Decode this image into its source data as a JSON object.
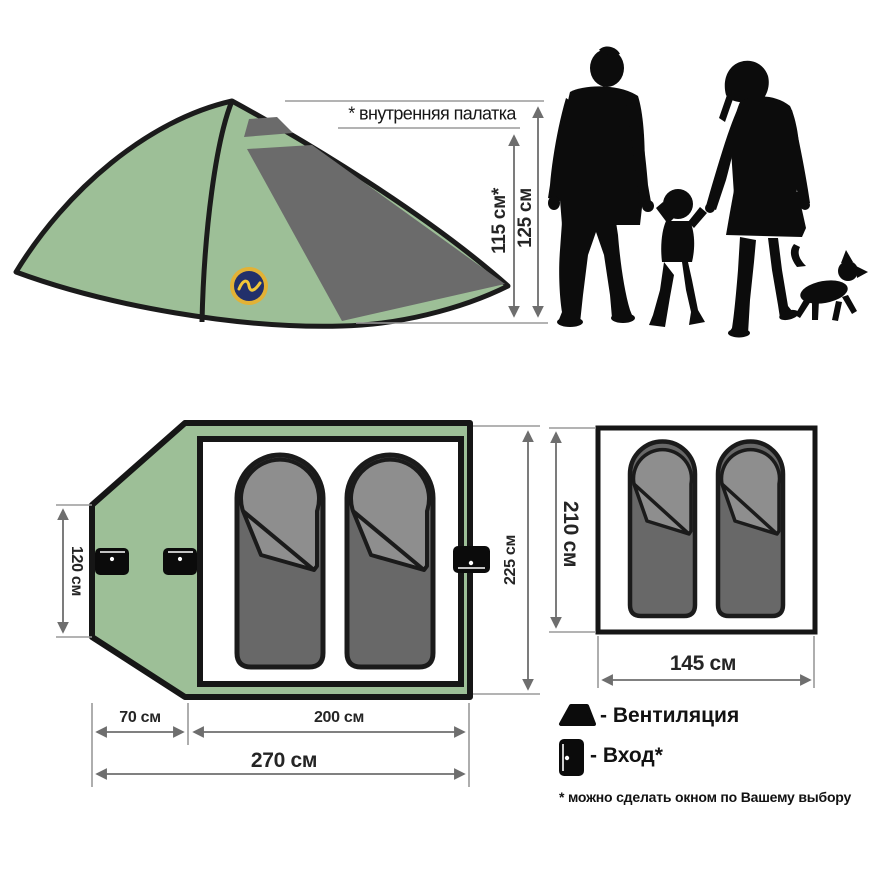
{
  "diagram": {
    "tent_side_view": {
      "note": "* внутренняя палатка",
      "inner_height": "115 см*",
      "outer_height": "125 см"
    },
    "outer_floor_plan": {
      "vestibule_width": "120 см",
      "tent_width": "225 см",
      "vestibule_depth": "70 см",
      "inner_depth": "200 см",
      "total_depth": "270 см"
    },
    "inner_floor_plan": {
      "height": "210 см",
      "width": "145 см"
    },
    "legend": {
      "ventilation_label": "- Вентиляция",
      "entrance_label": "- Вход*",
      "footnote": "* можно сделать окном по Вашему выбору"
    },
    "colors": {
      "tent_green": "#9dbf97",
      "panel_gray": "#6b6b6b",
      "bag_dark": "#686868",
      "bag_light": "#8e8e8e",
      "outline": "#1b1b1b",
      "dim_line": "#6e6e6e",
      "logo_navy": "#22306B",
      "logo_gold": "#E2B236"
    }
  }
}
